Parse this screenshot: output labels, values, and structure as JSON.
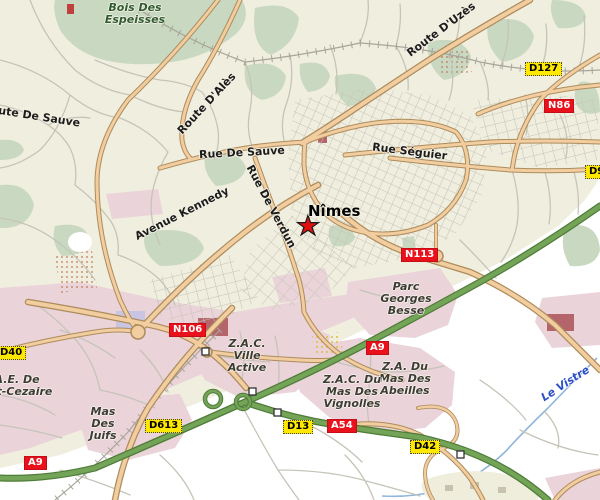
{
  "map": {
    "city": {
      "name": "Nîmes"
    },
    "marker": {
      "type": "star",
      "color": "#e01010"
    },
    "river": {
      "name": "Le Vistre",
      "label_color": "#2b4fc8"
    },
    "forest": {
      "name_lines": [
        "Bois Des",
        "Espeisses"
      ],
      "label_color": "#2f5b2f"
    },
    "road_names": {
      "route_de_sauve": "Route De Sauve",
      "rue_de_sauve": "Rue De Sauve",
      "rue_seguier": "Rue Séguier",
      "avenue_kennedy": "Avenue Kennedy",
      "rue_de_verdun": "Rue De Verdun",
      "route_d_ales": "Route D'Alès",
      "route_d_uzes": "Route D'Uzès"
    },
    "districts": {
      "parc_georges_besse": [
        "Parc",
        "Georges",
        "Besse"
      ],
      "zac_ville_active": [
        "Z.A.C.",
        "Ville",
        "Active"
      ],
      "zae_saint_cezaire": [
        "Z.A.E. De",
        "Saint-Cezaire"
      ],
      "mas_des_juifs": [
        "Mas",
        "Des",
        "Juifs"
      ],
      "za_du_mas_des_abeilles": [
        "Z.A. Du",
        "Mas Des",
        "Abeilles"
      ],
      "zac_du_mas_des_vignolles": [
        "Z.A.C. Du",
        "Mas Des",
        "Vignolles"
      ]
    },
    "route_shields": [
      {
        "id": "d127",
        "label": "D127",
        "style": "yellow"
      },
      {
        "id": "d9",
        "label": "D9",
        "style": "yellow"
      },
      {
        "id": "n86",
        "label": "N86",
        "style": "red"
      },
      {
        "id": "n113",
        "label": "N113",
        "style": "red"
      },
      {
        "id": "n106",
        "label": "N106",
        "style": "red"
      },
      {
        "id": "d40",
        "label": "D40",
        "style": "yellow"
      },
      {
        "id": "a9_east",
        "label": "A9",
        "style": "red"
      },
      {
        "id": "d613",
        "label": "D613",
        "style": "yellow"
      },
      {
        "id": "d13",
        "label": "D13",
        "style": "yellow"
      },
      {
        "id": "a54",
        "label": "A54",
        "style": "red"
      },
      {
        "id": "d42",
        "label": "D42",
        "style": "yellow"
      },
      {
        "id": "a9_west",
        "label": "A9",
        "style": "red"
      }
    ],
    "colors": {
      "background": "#f0eedf",
      "outskirts_white": "#ffffff",
      "forest_green": "#c9d8c1",
      "urban_pink": "#ead3d9",
      "road_tan": "#f1cda0",
      "road_casing": "#ad8c5c",
      "minor_road_gray": "#c6c4b8",
      "motorway_green": "#74a457",
      "motorway_casing": "#4e7c38",
      "river_blue": "#8fb6dc",
      "shield_yellow": "#ffe800",
      "shield_red": "#e8111c"
    }
  }
}
